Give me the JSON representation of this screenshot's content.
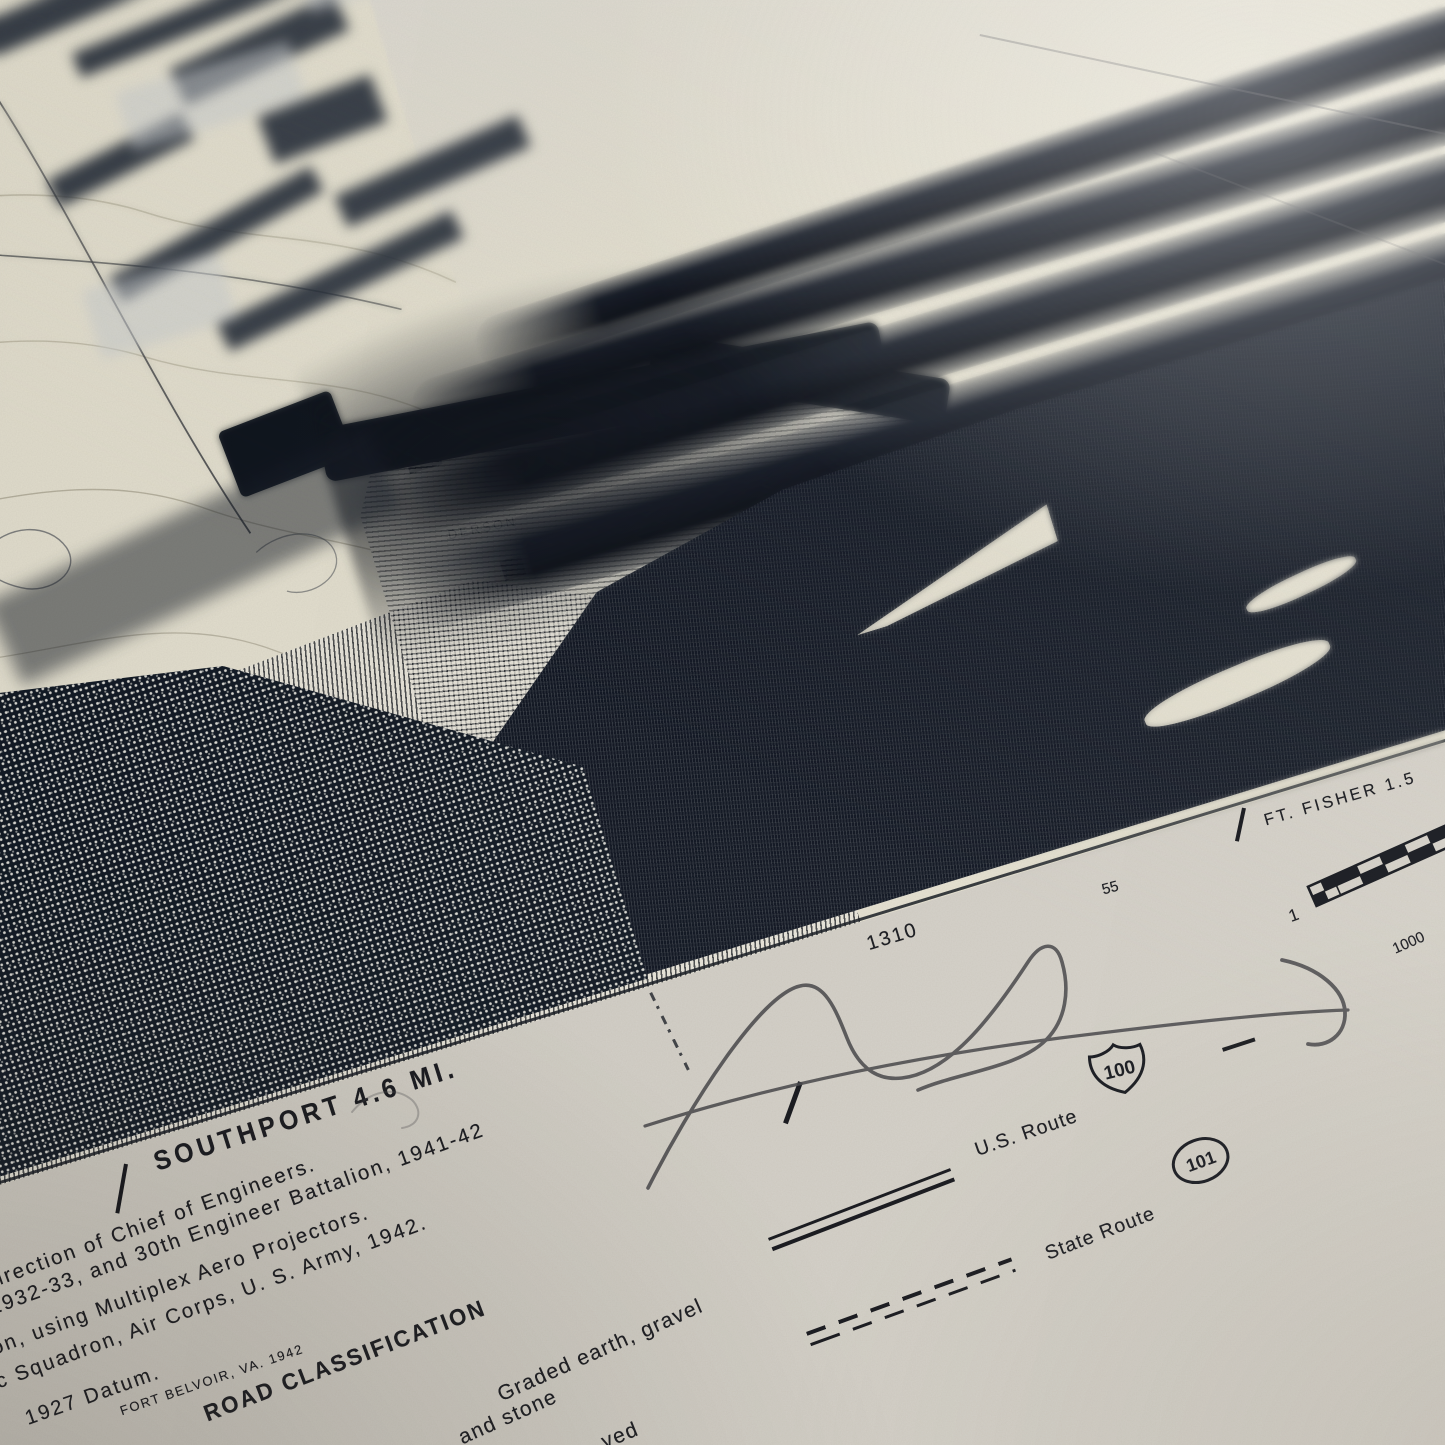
{
  "map": {
    "edge_labels": {
      "southport": "SOUTHPORT 4.6 MI.",
      "ft_fisher": "FT. FISHER 1.5"
    },
    "numbers": {
      "grid_1310": "1310",
      "grid_55": "55",
      "scale_left": "1",
      "scale_bottom": "1000"
    },
    "place_fragment": "DERSON"
  },
  "credits": {
    "line1": "irection of Chief of Engineers.",
    "line2": "1932-33, and 30th Engineer Battalion, 1941-42",
    "line3": "on, using Multiplex Aero Projectors.",
    "line4": "ic Squadron, Air Corps, U. S. Army, 1942.",
    "line5": "1927 Datum.",
    "line6": "FORT BELVOIR, VA.   1942"
  },
  "legend": {
    "title": "ROAD CLASSIFICATION",
    "graded_line1": "Graded earth, gravel",
    "graded_line2": "and stone",
    "partial_bottom": "ved",
    "us_route": "U.S. Route",
    "us_route_number": "100",
    "state_route": "State Route",
    "state_route_number": "101"
  },
  "colors": {
    "paper": "#d9d5cc",
    "map_cream": "#e9e5d3",
    "ink": "#11161f",
    "pencil": "#48484b"
  }
}
